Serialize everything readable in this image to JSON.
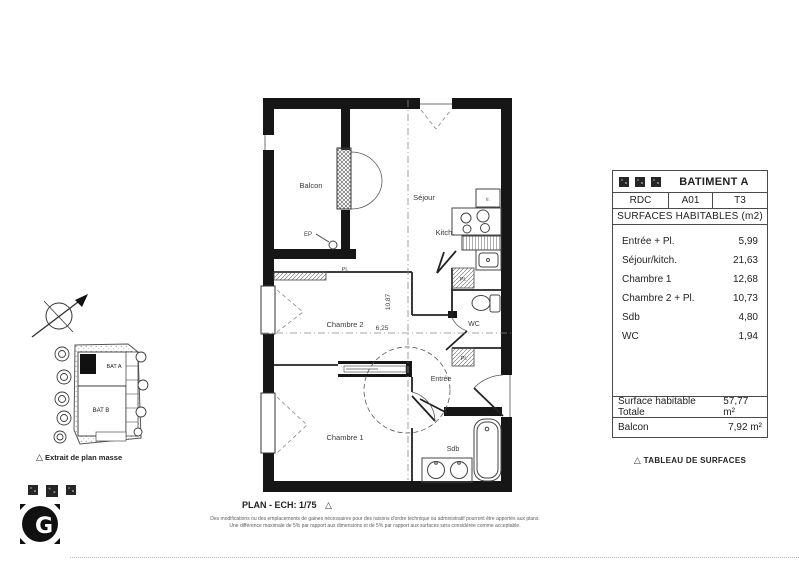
{
  "icons": {
    "triangle": "△"
  },
  "table": {
    "title": "BATIMENT A",
    "level": "RDC",
    "unit": "A01",
    "type": "T3",
    "subtitle": "SURFACES HABITABLES (m2)",
    "rooms": [
      {
        "label": "Entrée + Pl.",
        "value": "5,99"
      },
      {
        "label": "Séjour/kitch.",
        "value": "21,63"
      },
      {
        "label": "Chambre 1",
        "value": "12,68"
      },
      {
        "label": "Chambre 2 + Pl.",
        "value": "10,73"
      },
      {
        "label": "Sdb",
        "value": "4,80"
      },
      {
        "label": "WC",
        "value": "1,94"
      }
    ],
    "totals": [
      {
        "label": "Surface habitable Totale",
        "value": "57,77 m²"
      },
      {
        "label": "Balcon",
        "value": "7,92 m²"
      }
    ],
    "caption": "TABLEAU DE SURFACES"
  },
  "plan": {
    "caption": "PLAN - ECH: 1/75",
    "rooms": {
      "balcon": "Balcon",
      "sejour": "Séjour",
      "kitch": "Kitch.",
      "chambre2": "Chambre 2",
      "chambre1": "Chambre 1",
      "entree": "Entrée",
      "wc": "WC",
      "sdb": "Sdb"
    },
    "annotations": {
      "ep": "EP",
      "pl": "Pl.",
      "fr": "fr.",
      "dim_height": "10,87",
      "dim_width": "6,25"
    }
  },
  "site": {
    "bat_a": "BAT A",
    "bat_b": "BAT B",
    "caption": "Extrait de plan masse"
  },
  "logo": {
    "letter": "G"
  },
  "footnote": {
    "line1": "Des modifications ou des emplacements de gaines nécessaires pour des raisons d'ordre technique ou administratif pourront être apportés aux plans.",
    "line2": "Une différence maximale de 5% par rapport aux dimensions et de 5% par rapport aux surfaces sera considérée comme acceptable."
  }
}
